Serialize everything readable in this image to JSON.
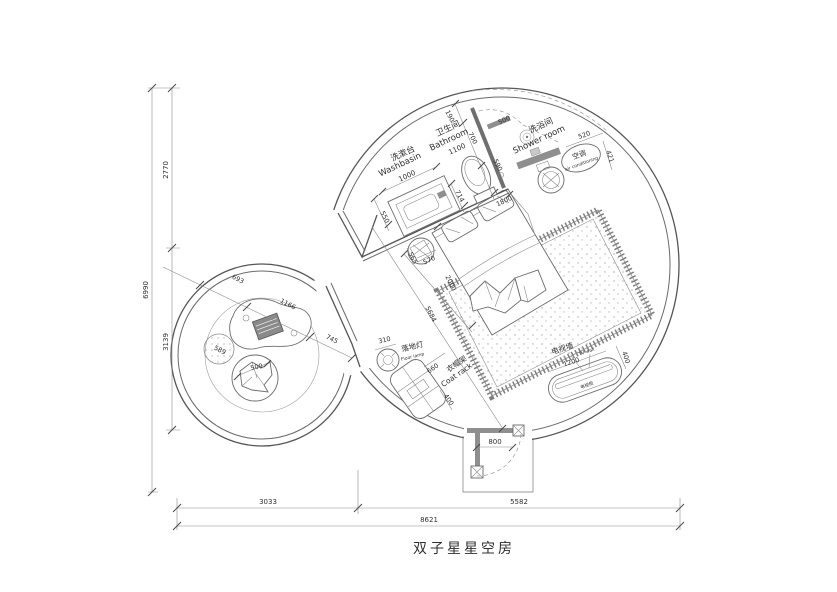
{
  "title": {
    "text": "双子星星空房"
  },
  "dims_left": {
    "total": "6990",
    "top": "2770",
    "bottom": "3139"
  },
  "dims_bottom": {
    "left": "3033",
    "right": "5582",
    "total": "8621"
  },
  "washbasin": {
    "zh": "洗漱台",
    "en": "Washbasin",
    "w": "1000",
    "depth": "550"
  },
  "bathroom": {
    "zh": "卫生间",
    "en": "Bathroom",
    "w": "1100",
    "d190": "190",
    "d700": "700",
    "d590": "590",
    "d714": "714",
    "d1800": "1800"
  },
  "shower": {
    "zh": "洗浴间",
    "en": "Shower room",
    "door": "500"
  },
  "ac": {
    "zh": "空调",
    "en": "air conditioning",
    "d520": "520",
    "d421": "421"
  },
  "bed": {
    "d2000": "2000",
    "d5684": "5684",
    "d565": "565",
    "d570": "570"
  },
  "lamp": {
    "zh": "落地灯",
    "en": "Floor lamp",
    "d310": "310"
  },
  "rack": {
    "zh": "衣帽架",
    "en": "Coat rack",
    "d660": "660",
    "d400": "400"
  },
  "tv": {
    "zh": "电视墙",
    "en": "TV wall",
    "cabinet": "电视柜",
    "d1200": "1200",
    "d400": "400"
  },
  "door": {
    "d800": "800"
  },
  "lounge": {
    "d693": "693",
    "d1166": "1166",
    "d745": "745",
    "d589": "589",
    "d500": "500"
  },
  "colors": {
    "line": "#555555",
    "light_line": "#9b9b9b",
    "gray_fill": "#8f8f8f",
    "background": "#ffffff",
    "text": "#2f2f2f"
  }
}
